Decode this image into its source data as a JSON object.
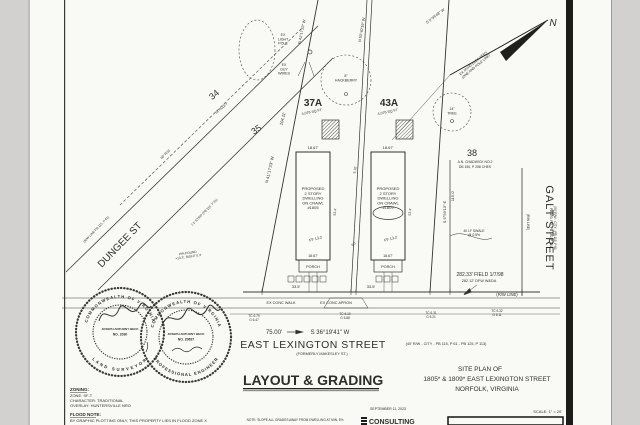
{
  "title_block": {
    "drawing_title": "LAYOUT & GRADING",
    "site_plan_of": "SITE PLAN OF",
    "address_line": "1805* & 1809* EAST LEXINGTON STREET",
    "city_line": "NORFOLK, VIRGINIA",
    "date": "SEPTEMBER 11, 2023",
    "scale": "SCALE: 1\" = 20'",
    "consulting_logo": "CONSULTING",
    "bottom_note": "NOTE: SLOPE ALL GRADES AWAY FROM DWELLING AT MIN. 5%"
  },
  "zoning_block": {
    "heading": "ZONING:",
    "zone": "ZONE: SF-T",
    "character": "CHARACTER: TRADITIONAL",
    "overlay": "OVERLAY: HUNTERSVILLE NRO",
    "flood_heading": "FLOOD NOTE:",
    "flood_text": "BY GRAPHIC PLOTTING ONLY, THIS PROPERTY LIES IN FLOOD ZONE X"
  },
  "seals": {
    "left": {
      "arc_top": "COMMONWEALTH OF VIRGINIA",
      "name": "JOSEPH ANTHONY BECK",
      "number": "NO. 2030",
      "arc_bottom": "LAND SURVEYOR"
    },
    "right": {
      "arc_top": "COMMONWEALTH OF VIRGINIA",
      "name": "JOSEPH ANTHONY BECK",
      "number": "NO. 20697",
      "arc_bottom": "PROFESSIONAL ENGINEER"
    }
  },
  "plan_labels": [
    {
      "name": "ex-light-pole-note",
      "lines": [
        "EX",
        "LIGHT",
        "POLE"
      ],
      "x": 283,
      "y": 36,
      "size": 3.6
    },
    {
      "name": "ex-guy-wires-note",
      "lines": [
        "EX",
        "GUY",
        "WIRES"
      ],
      "x": 284,
      "y": 66,
      "size": 3.6
    },
    {
      "name": "hackberry-label",
      "lines": [
        "8\"",
        "HACKBERRY"
      ],
      "x": 346,
      "y": 77,
      "size": 3.6
    },
    {
      "name": "tree-14-label",
      "lines": [
        "14\"",
        "TREE"
      ],
      "x": 452,
      "y": 110,
      "size": 3.6
    },
    {
      "name": "bearing-top-left",
      "text": "N 41°17'23\" W",
      "x": 303,
      "y": 32,
      "rot": -78,
      "size": 3.8
    },
    {
      "name": "bearing-top-mid",
      "text": "N 53°40'19\" W",
      "x": 363,
      "y": 30,
      "rot": -80,
      "size": 3.8
    },
    {
      "name": "bearing-top-right",
      "text": "S 5°59'48\" W",
      "x": 436,
      "y": 17,
      "rot": -38,
      "size": 3.8
    },
    {
      "name": "ovhd-elec-note",
      "lines": [
        "EX OVHD ELEC SERV",
        "(ONE AND POLE LINE)"
      ],
      "x": 474,
      "y": 64,
      "rot": -40,
      "size": 3.4
    },
    {
      "name": "north-label",
      "text": "N",
      "x": 553,
      "y": 26,
      "size": 10,
      "italic": true
    },
    {
      "name": "lot-34-label",
      "text": "34",
      "x": 216,
      "y": 97,
      "rot": -40,
      "size": 9
    },
    {
      "name": "alley-note",
      "text": "16' ALLEY",
      "x": 222,
      "y": 109,
      "rot": -40,
      "size": 3.4
    },
    {
      "name": "dungee-rw-width",
      "text": "60' R/W",
      "x": 166,
      "y": 155,
      "rot": -44,
      "size": 3.4
    },
    {
      "name": "lot-35-label",
      "text": "35",
      "x": 258,
      "y": 132,
      "rot": -35,
      "size": 9
    },
    {
      "name": "dim-104",
      "text": "104.11'",
      "x": 284,
      "y": 119,
      "rot": -76,
      "size": 4.2
    },
    {
      "name": "bearing-37a-west",
      "text": "N 41°17'23\" W",
      "x": 271,
      "y": 170,
      "rot": -77,
      "size": 4.2
    },
    {
      "name": "lot-37a-label",
      "text": "37A",
      "x": 313,
      "y": 106,
      "size": 10,
      "bold": true
    },
    {
      "name": "lot-37a-area",
      "text": "4,076 SQ FT",
      "x": 312,
      "y": 113,
      "rot": -12,
      "size": 3.6
    },
    {
      "name": "lot-43a-label",
      "text": "43A",
      "x": 389,
      "y": 106,
      "size": 10,
      "bold": true
    },
    {
      "name": "lot-43a-area",
      "text": "4,076 SQ FT",
      "x": 388,
      "y": 113,
      "rot": -12,
      "size": 3.6
    },
    {
      "name": "dim-width-37a",
      "text": "18.67'",
      "x": 313,
      "y": 149,
      "size": 4
    },
    {
      "name": "dim-width-43a",
      "text": "18.67'",
      "x": 388,
      "y": 149,
      "size": 4
    },
    {
      "name": "dwelling-1805-label",
      "lines": [
        "PROPOSED",
        "2 STORY",
        "DWELLING",
        "ON CRAWL",
        "#1805"
      ],
      "x": 313,
      "y": 190,
      "size": 4
    },
    {
      "name": "dwelling-1809-label",
      "lines": [
        "PROPOSED",
        "2 STORY",
        "DWELLING",
        "ON CRAWL",
        "#1809"
      ],
      "x": 388,
      "y": 190,
      "size": 4
    },
    {
      "name": "ff-37a",
      "text": "FF 13.2",
      "x": 316,
      "y": 240,
      "rot": -15,
      "size": 3.8
    },
    {
      "name": "ff-43a",
      "text": "FF 13.2",
      "x": 391,
      "y": 240,
      "rot": -15,
      "size": 3.8
    },
    {
      "name": "side-dim-37a",
      "text": "53.4'",
      "x": 336,
      "y": 212,
      "rot": -85,
      "size": 3.4
    },
    {
      "name": "side-dim-43a",
      "text": "53.4'",
      "x": 411,
      "y": 212,
      "rot": -85,
      "size": 3.4
    },
    {
      "name": "dim-5-10",
      "text": "5.10'",
      "x": 356,
      "y": 170,
      "rot": -80,
      "size": 3.4
    },
    {
      "name": "spot-elev",
      "text": "6.3",
      "x": 354,
      "y": 245,
      "rot": -30,
      "size": 3.2
    },
    {
      "name": "lot-38-label",
      "text": "38",
      "x": 472,
      "y": 156,
      "size": 9
    },
    {
      "name": "lot-38-owner",
      "text": "A.N. CHADWICK NO.2",
      "x": 475,
      "y": 163,
      "size": 3.4
    },
    {
      "name": "lot-38-deed",
      "text": "DB 150, P 258 CHES",
      "x": 475,
      "y": 168,
      "size": 3.4
    },
    {
      "name": "bearing-43a-east",
      "text": "S 5°59'13\" E",
      "x": 446,
      "y": 212,
      "rot": -90,
      "size": 4
    },
    {
      "name": "dim-115",
      "text": "115.0'",
      "x": 454,
      "y": 196,
      "rot": -90,
      "size": 4
    },
    {
      "name": "swale-note",
      "lines": [
        "40 LF SWALE",
        "@ 0.5%"
      ],
      "x": 474,
      "y": 232,
      "size": 3.4
    },
    {
      "name": "porch-37a-label",
      "text": "PORCH",
      "x": 313,
      "y": 268,
      "size": 3.8
    },
    {
      "name": "porch-43a-label",
      "text": "PORCH",
      "x": 388,
      "y": 268,
      "size": 3.8
    },
    {
      "name": "dim-porch-37a",
      "text": "18.67'",
      "x": 313,
      "y": 257,
      "size": 3.6
    },
    {
      "name": "dim-porch-43a",
      "text": "18.67'",
      "x": 388,
      "y": 257,
      "size": 3.6
    },
    {
      "name": "dim-frontage-37a",
      "text": "33.5'",
      "x": 296,
      "y": 288,
      "size": 4
    },
    {
      "name": "dim-frontage-43a",
      "text": "33.5'",
      "x": 371,
      "y": 288,
      "size": 4
    },
    {
      "name": "street-dungee-label",
      "text": "DUNGEE ST",
      "x": 122,
      "y": 247,
      "rot": -46,
      "size": 10
    },
    {
      "name": "dungee-rw-note",
      "text": "(R/W LINE PB 115, P 61)",
      "x": 97,
      "y": 230,
      "rot": -46,
      "size": 3.2
    },
    {
      "name": "strip-note",
      "text": "7.5' STRIP (PB 115, P 61)",
      "x": 205,
      "y": 213,
      "rot": -46,
      "size": 3.2
    },
    {
      "name": "pin-found-note",
      "lines": [
        "PIN FOUND",
        "+13.3', RIGHT 0.3'"
      ],
      "x": 188,
      "y": 254,
      "rot": -8,
      "size": 3.2
    },
    {
      "name": "walk-note",
      "text": "EX CONC WALK",
      "x": 281,
      "y": 304,
      "size": 3.8
    },
    {
      "name": "apron-note",
      "text": "EX CONC APRON",
      "x": 336,
      "y": 304,
      "size": 3.8
    },
    {
      "name": "tc-elev-1",
      "lines": [
        "TC 6.79",
        "G 6.47"
      ],
      "x": 254,
      "y": 317,
      "size": 3.2
    },
    {
      "name": "tc-elev-2",
      "lines": [
        "TC 6.10",
        "G 5.88"
      ],
      "x": 345,
      "y": 315,
      "size": 3.2
    },
    {
      "name": "tc-elev-3",
      "lines": [
        "TC 6.31",
        "G 6.21"
      ],
      "x": 431,
      "y": 314,
      "size": 3.2
    },
    {
      "name": "tc-elev-4",
      "lines": [
        "TC 6.32",
        "G 6.11"
      ],
      "x": 497,
      "y": 312,
      "size": 3.2
    },
    {
      "name": "dim-75",
      "text": "75.00'",
      "x": 274,
      "y": 334,
      "size": 6
    },
    {
      "name": "bearing-lexington",
      "text": "S 36°19'41\" W",
      "x": 330,
      "y": 334,
      "size": 6
    },
    {
      "name": "street-east-lexington",
      "text": "EAST LEXINGTON STREET",
      "x": 313,
      "y": 348,
      "size": 10.5,
      "spacing": 0.5
    },
    {
      "name": "lexington-rw-note",
      "text": "(40' R/W - CITY - PB 115, P 61 - PB 125, P 113)",
      "x": 446,
      "y": 345,
      "size": 3.8
    },
    {
      "name": "lexington-formerly-note",
      "text": "(FORMERLY MAKESLEY ST.)",
      "x": 322,
      "y": 355,
      "size": 3.8
    },
    {
      "name": "field-dim",
      "text": "282.33' FIELD 1/7/98",
      "x": 480,
      "y": 276,
      "size": 5
    },
    {
      "name": "field-dim-2",
      "text": "282.12' DFW W&DA",
      "x": 479,
      "y": 282,
      "size": 3.8
    },
    {
      "name": "rw-line-note",
      "text": "(R/W LINE)",
      "x": 507,
      "y": 296,
      "size": 4.2
    },
    {
      "name": "rw-line-vert-note",
      "text": "(R/W LINE)",
      "x": 527,
      "y": 222,
      "rot": 90,
      "size": 3.2
    },
    {
      "name": "street-galt-label",
      "text": "GALT STREET",
      "x": 546,
      "y": 228,
      "rot": 90,
      "size": 11,
      "spacing": 1
    },
    {
      "name": "galt-rw-note",
      "lines": [
        "(50' R/W - CITY - PB 115, P 61",
        "PB 150, P 5, PB 140, P 111)"
      ],
      "x": 554,
      "y": 228,
      "rot": 90,
      "size": 3.2
    }
  ]
}
